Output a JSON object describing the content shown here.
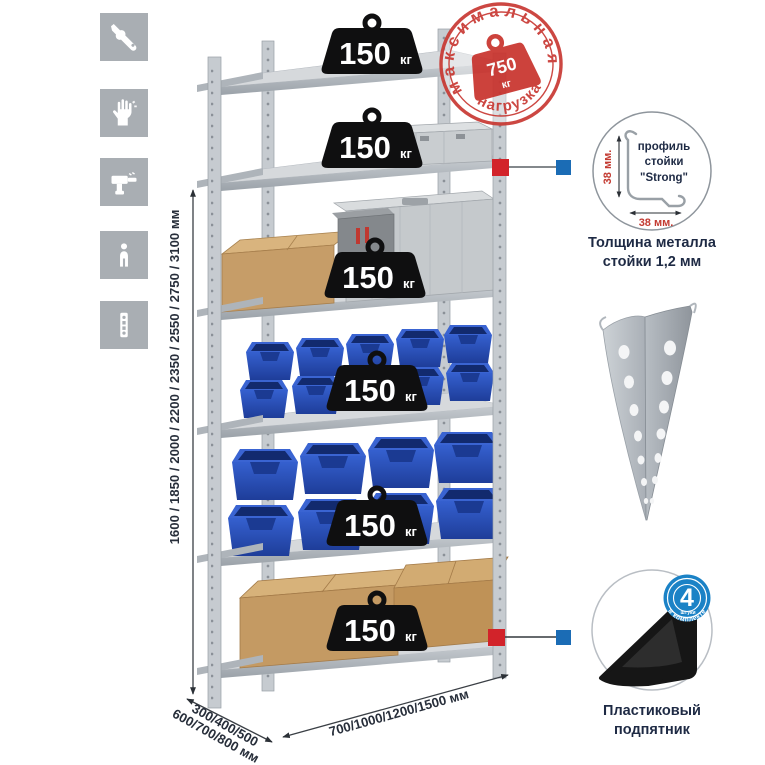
{
  "colors": {
    "accent_red": "#c93a34",
    "callout_red": "#d2232a",
    "callout_blue": "#1b6cb5",
    "badge_blue": "#1b82c6",
    "navy_text": "#1e2a44",
    "icon_gray": "#a9aeb3",
    "bin_blue": "#2b57c8"
  },
  "sidebar_icons": [
    {
      "name": "wrench"
    },
    {
      "name": "gloves"
    },
    {
      "name": "drill"
    },
    {
      "name": "person"
    },
    {
      "name": "upright-post"
    }
  ],
  "height_dimension": {
    "label": "1600 / 1850 / 2000 / 2200 / 2350 / 2550 / 2750 / 3100 мм"
  },
  "depth_dimension": {
    "line1": "300/400/500",
    "line2": "600/700/800 мм"
  },
  "width_dimension": {
    "label": "700/1000/1200/1500 мм"
  },
  "shelf_weights": [
    {
      "value": "150",
      "unit": "кг"
    },
    {
      "value": "150",
      "unit": "кг"
    },
    {
      "value": "150",
      "unit": "кг"
    },
    {
      "value": "150",
      "unit": "кг"
    },
    {
      "value": "150",
      "unit": "кг"
    },
    {
      "value": "150",
      "unit": "кг"
    }
  ],
  "max_load_stamp": {
    "arc_top": "максимальная",
    "arc_bottom": "нагрузка",
    "value": "750",
    "unit": "кг"
  },
  "profile_detail": {
    "label_line1": "профиль",
    "label_line2": "стойки",
    "label_line3": "\"Strong\"",
    "dim_left": "38 мм.",
    "dim_bottom": "38 мм.",
    "caption_line1": "Толщина металла",
    "caption_line2": "стойки 1,2 мм"
  },
  "foot_detail": {
    "badge_number": "4",
    "badge_word": "штуки",
    "badge_arc": "в комплекте",
    "caption_line1": "Пластиковый",
    "caption_line2": "подпятник"
  }
}
